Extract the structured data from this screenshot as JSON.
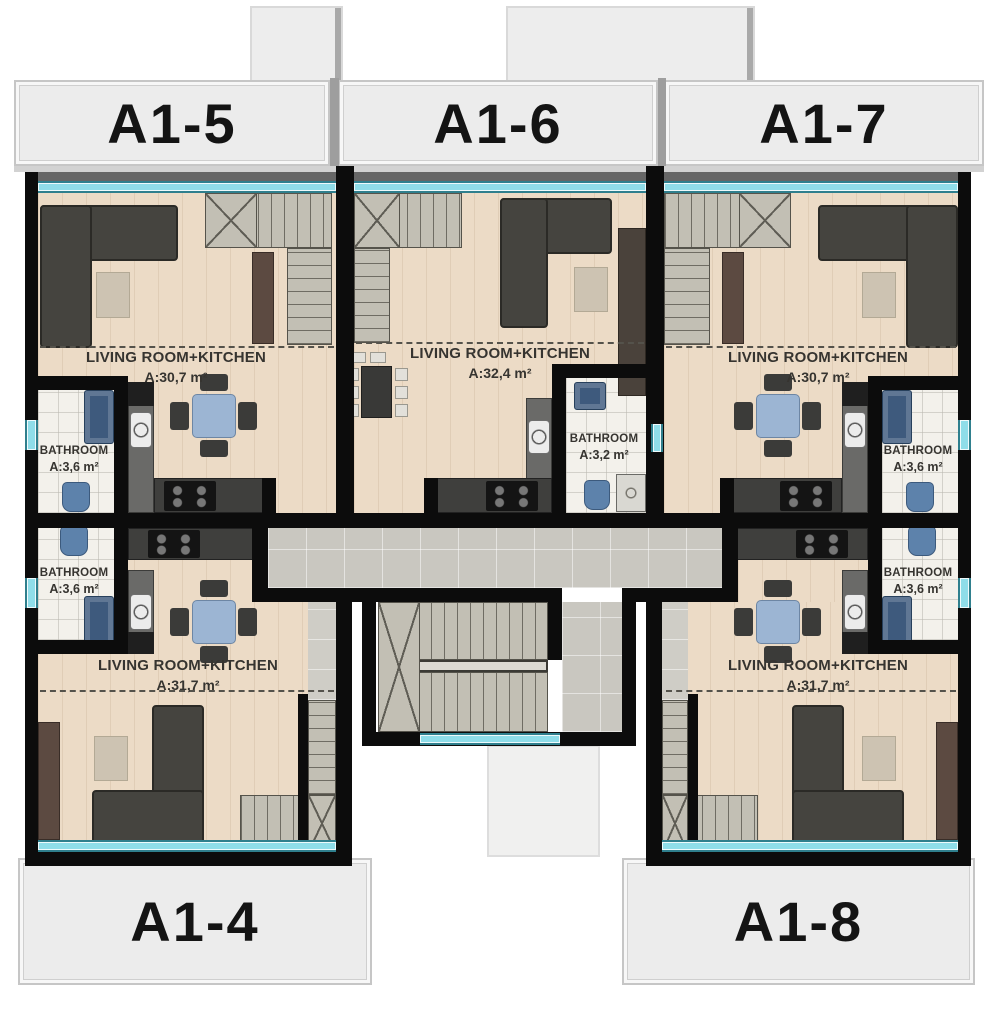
{
  "document": {
    "type": "apartment floor plan"
  },
  "units": [
    {
      "id": "A1-5",
      "living": {
        "label": "LIVING ROOM+KITCHEN",
        "area": "A:30,7 m²"
      },
      "bathroom": {
        "label": "BATHROOM",
        "area": "A:3,6 m²"
      }
    },
    {
      "id": "A1-6",
      "living": {
        "label": "LIVING ROOM+KITCHEN",
        "area": "A:32,4 m²"
      },
      "bathroom": {
        "label": "BATHROOM",
        "area": "A:3,2 m²"
      }
    },
    {
      "id": "A1-7",
      "living": {
        "label": "LIVING ROOM+KITCHEN",
        "area": "A:30,7 m²"
      },
      "bathroom": {
        "label": "BATHROOM",
        "area": "A:3,6 m²"
      }
    },
    {
      "id": "A1-4",
      "living": {
        "label": "LIVING ROOM+KITCHEN",
        "area": "A:31,7 m²"
      },
      "bathroom": {
        "label": "BATHROOM",
        "area": "A:3,6 m²"
      }
    },
    {
      "id": "A1-8",
      "living": {
        "label": "LIVING ROOM+KITCHEN",
        "area": "A:31,7 m²"
      },
      "bathroom": {
        "label": "BATHROOM",
        "area": "A:3,6 m²"
      }
    }
  ],
  "colors": {
    "wall": "#0c0c0c",
    "wood_floor": "#ecdbc6",
    "bath_floor": "#f3f1eb",
    "corridor": "#c9c7c0",
    "stair": "#c2bfb4",
    "window": "#8fdde9",
    "sofa": "#45443f",
    "rug": "#cdc3b2",
    "dining_table": "#9cb5d3",
    "label_background": "#ececec"
  }
}
